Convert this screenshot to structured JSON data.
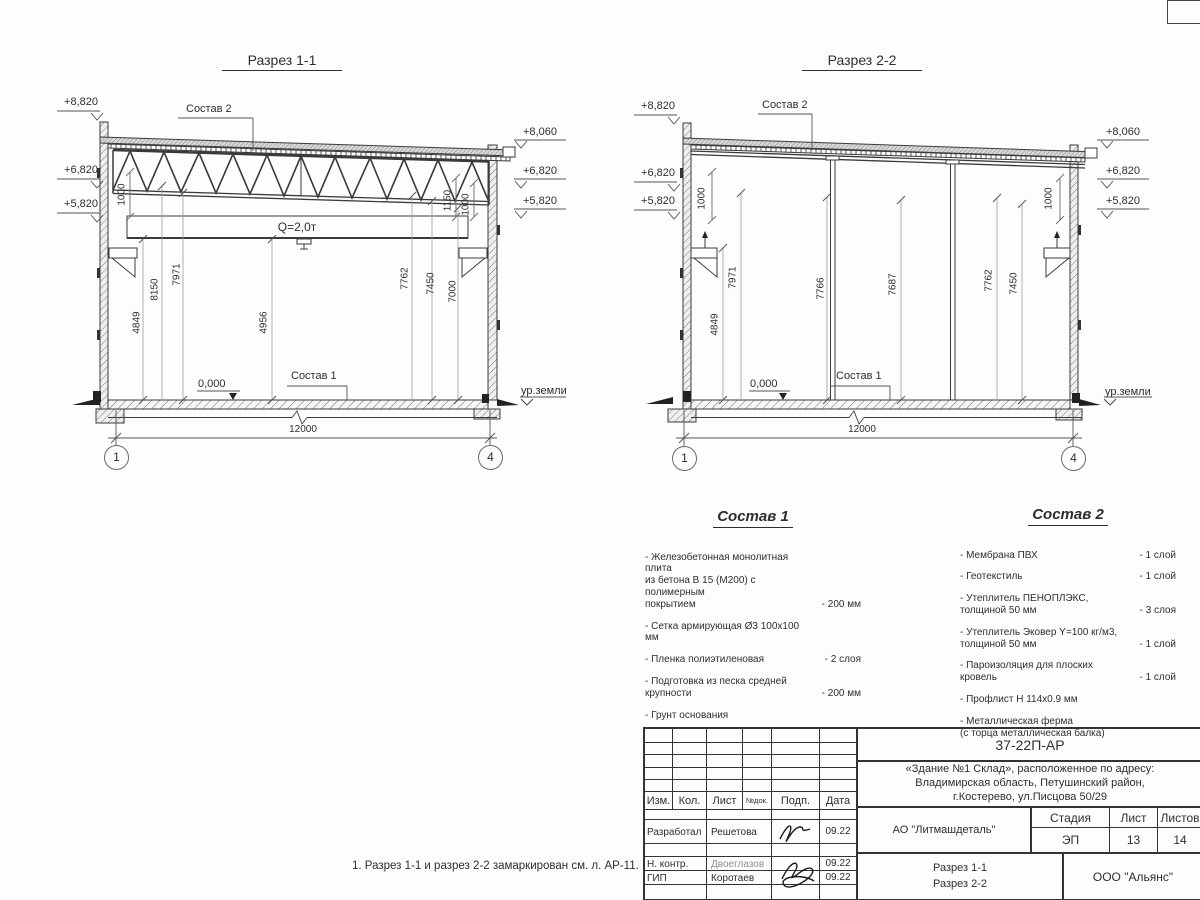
{
  "sections": {
    "s1": {
      "title": "Разрез 1-1",
      "elev_left": [
        "+8,820",
        "+6,820",
        "+5,820"
      ],
      "elev_right": [
        "+8,060",
        "+6,820",
        "+5,820"
      ],
      "roof_label": "Состав 2",
      "floor_label": "Состав 1",
      "crane": "Q=2,0т",
      "gap_dims": [
        "1000",
        "1150",
        "1000"
      ],
      "heights": [
        "4849",
        "8150",
        "7971",
        "4956",
        "7762",
        "7450",
        "7000"
      ],
      "zero": "0,000",
      "ground": "ур.земли",
      "span": "12000",
      "axes": [
        "1",
        "4"
      ]
    },
    "s2": {
      "title": "Разрез 2-2",
      "elev_left": [
        "+8,820",
        "+6,820",
        "+5,820"
      ],
      "elev_right": [
        "+8,060",
        "+6,820",
        "+5,820"
      ],
      "roof_label": "Состав 2",
      "floor_label": "Состав 1",
      "gap_dims": [
        "1000",
        "1000"
      ],
      "heights": [
        "4849",
        "7971",
        "7766",
        "7687",
        "7762",
        "7450"
      ],
      "zero": "0,000",
      "ground": "ур.земли",
      "span": "12000",
      "axes": [
        "1",
        "4"
      ]
    }
  },
  "sostav1": {
    "title": "Состав 1",
    "items": [
      {
        "text": "- Железобетонная  монолитная плита\nиз бетона В 15 (М200) с полимерным\nпокрытием",
        "value": "- 200 мм"
      },
      {
        "text": "- Сетка армирующая Ø3 100х100 мм",
        "value": ""
      },
      {
        "text": "- Пленка полиэтиленовая",
        "value": "-  2 слоя"
      },
      {
        "text": "- Подготовка из песка средней\n  крупности",
        "value": "- 200 мм"
      },
      {
        "text": "- Грунт основания",
        "value": ""
      }
    ]
  },
  "sostav2": {
    "title": "Состав 2",
    "items": [
      {
        "text": "- Мембрана ПВХ",
        "value": "- 1 слой"
      },
      {
        "text": "- Геотекстиль",
        "value": "- 1 слой"
      },
      {
        "text": "- Утеплитель ПЕНОПЛЭКС,\n  толщиной 50 мм",
        "value": "- 3 слоя"
      },
      {
        "text": "- Утеплитель Эковер Y=100 кг/м3,\n  толщиной 50 мм",
        "value": "- 1 слой"
      },
      {
        "text": "- Пароизоляция для плоских кровель",
        "value": "- 1 слой"
      },
      {
        "text": "- Профлист Н 114х0.9 мм",
        "value": ""
      },
      {
        "text": "- Металлическая ферма\n  (с торца металлическая балка)",
        "value": ""
      }
    ]
  },
  "note": "1. Разрез 1-1 и разрез 2-2 замаркирован см. л. АР-11.",
  "titleblock": {
    "doc_number": "37-22П-АР",
    "object": "«Здание №1 Склад», расположенное по адресу:\nВладимирская область, Петушинский район,\nг.Костерево, ул.Писцова 50/29",
    "cols": [
      "Изм.",
      "Кол.",
      "Лист",
      "№док.",
      "Подп.",
      "Дата"
    ],
    "rows": [
      {
        "role": "Разработал",
        "name": "Решетова",
        "date": "09.22"
      },
      {
        "role": "Н. контр.",
        "name": "Двоеглазов",
        "date": "09.22"
      },
      {
        "role": "ГИП",
        "name": "Коротаев",
        "date": "09.22"
      }
    ],
    "customer": "АО \"Литмашдеталь\"",
    "stage_label": "Стадия",
    "sheet_label": "Лист",
    "sheets_label": "Листов",
    "stage": "ЭП",
    "sheet": "13",
    "sheets": "14",
    "content": "Разрез 1-1\nРазрез 2-2",
    "org": "ООО \"Альянс\""
  }
}
